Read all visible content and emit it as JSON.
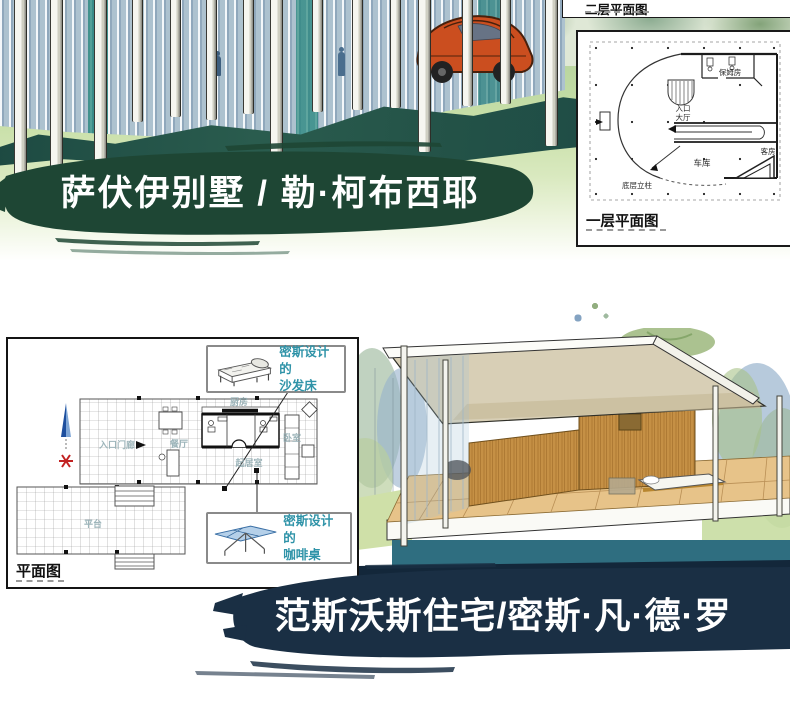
{
  "colors": {
    "banner_green": "#1e4634",
    "banner_navy": "#1a2f44",
    "callout_teal": "#2f93a8",
    "lawn_green": "#cfe3ae",
    "shadow_teal": "#235247",
    "plan_line": "#333333"
  },
  "villa_savoye": {
    "banner_text": "萨伏伊别墅 / 勒·柯布西耶",
    "upper_plan_label": "二层平面图",
    "lower_plan_label": "一层平面图",
    "rooms": {
      "maid_room": "保姆房",
      "entrance_line1": "入口",
      "entrance_line2": "大厅",
      "garage": "车库",
      "guest_room": "客房",
      "ground_columns": "底层立柱"
    }
  },
  "farnsworth": {
    "banner_text": "范斯沃斯住宅/密斯·凡·德·罗",
    "plan_label": "平面图",
    "callouts": {
      "sofa_line1": "密斯设计的",
      "sofa_line2": "沙发床",
      "table_line1": "密斯设计的",
      "table_line2": "咖啡桌"
    },
    "rooms": {
      "entrance_porch": "入口门廊",
      "dining": "餐厅",
      "kitchen": "厨房",
      "bedroom": "卧室",
      "living": "起居室",
      "terrace": "平台"
    }
  }
}
